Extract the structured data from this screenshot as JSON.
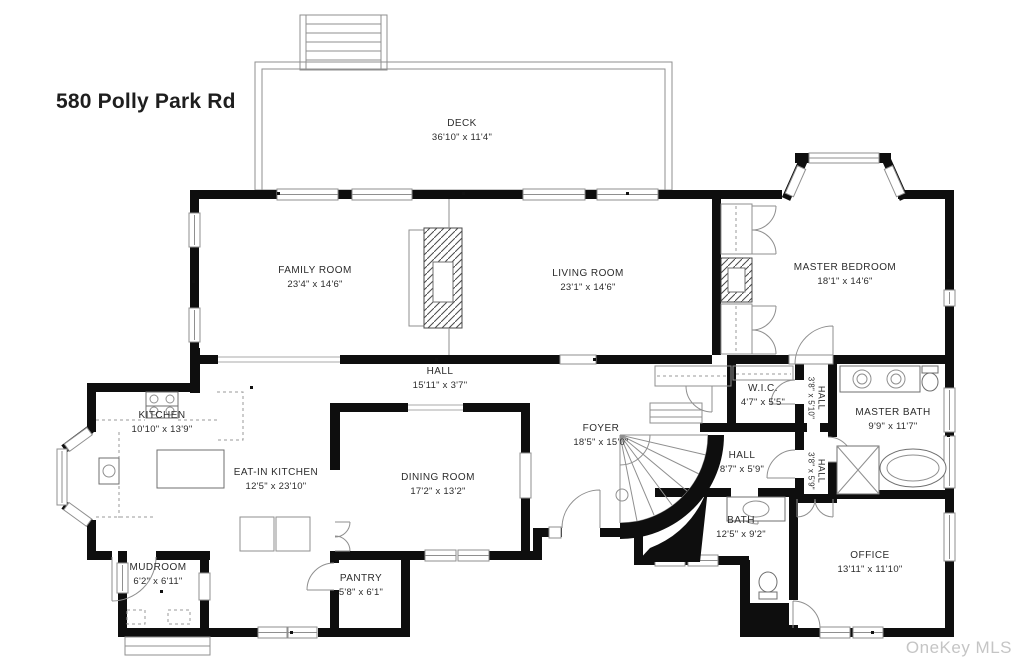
{
  "title": "580 Polly Park Rd",
  "watermark": "OneKey MLS",
  "colors": {
    "wall": "#0e0e0e",
    "thin_line": "#8f8f8f",
    "label_text": "#2c2c2c",
    "watermark": "#c5c5c5",
    "background": "#ffffff"
  },
  "rooms": {
    "deck": {
      "name": "DECK",
      "dims": "36'10\" x 11'4\""
    },
    "family_room": {
      "name": "FAMILY ROOM",
      "dims": "23'4\" x 14'6\""
    },
    "living_room": {
      "name": "LIVING ROOM",
      "dims": "23'1\" x 14'6\""
    },
    "master_bedroom": {
      "name": "MASTER BEDROOM",
      "dims": "18'1\" x 14'6\""
    },
    "hall_main": {
      "name": "HALL",
      "dims": "15'11\" x 3'7\""
    },
    "kitchen": {
      "name": "KITCHEN",
      "dims": "10'10\" x 13'9\""
    },
    "eat_in_kitchen": {
      "name": "EAT-IN KITCHEN",
      "dims": "12'5\" x 23'10\""
    },
    "dining_room": {
      "name": "DINING ROOM",
      "dims": "17'2\" x 13'2\""
    },
    "foyer": {
      "name": "FOYER",
      "dims": "18'5\" x 15'0\""
    },
    "wic": {
      "name": "W.I.C.",
      "dims": "4'7\" x 5'5\""
    },
    "hall_upper": {
      "name": "HALL",
      "dims": "3'8\" x 5'10\""
    },
    "master_bath": {
      "name": "MASTER BATH",
      "dims": "9'9\" x 11'7\""
    },
    "hall_center": {
      "name": "HALL",
      "dims": "8'7\" x 5'9\""
    },
    "hall_lower": {
      "name": "HALL",
      "dims": "3'8\" x 5'9\""
    },
    "bath": {
      "name": "BATH",
      "dims": "12'5\" x 9'2\""
    },
    "office": {
      "name": "OFFICE",
      "dims": "13'11\" x 11'10\""
    },
    "mudroom": {
      "name": "MUDROOM",
      "dims": "6'2\" x 6'11\""
    },
    "pantry": {
      "name": "PANTRY",
      "dims": "5'8\" x 6'1\""
    }
  }
}
